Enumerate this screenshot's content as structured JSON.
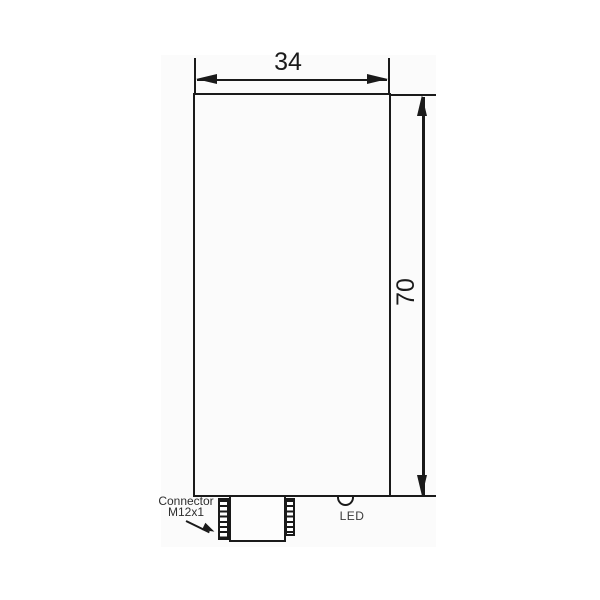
{
  "drawing": {
    "width_dimension_label": "34",
    "height_dimension_label": "70",
    "connector_label_line1": "Connector",
    "connector_label_line2": "M12x1",
    "led_label": "LED"
  },
  "colors": {
    "page_background": "#ffffff",
    "canvas_background": "#fbfbfb",
    "line": "#1a1a1a",
    "annotation_text": "#2e2e2e"
  }
}
